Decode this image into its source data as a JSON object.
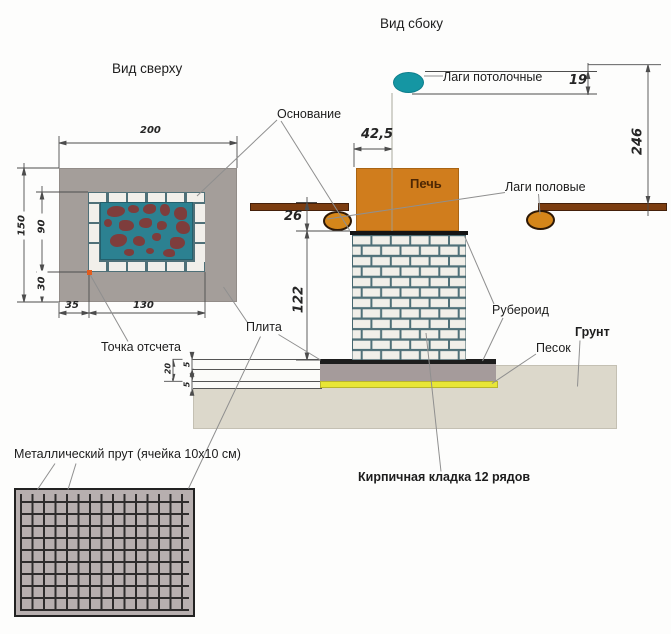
{
  "diagram": {
    "title_side_view": "Вид сбоку",
    "title_top_view": "Вид сверху",
    "labels": {
      "base": "Основание",
      "ceiling_joists": "Лаги потолочные",
      "furnace": "Печь",
      "floor_joists": "Лаги половые",
      "ruberoid": "Рубероид",
      "slab": "Плита",
      "reference_point": "Точка отсчета",
      "sand": "Песок",
      "ground": "Грунт",
      "metal_mesh": "Металлический прут (ячейка 10х10 см)",
      "brickwork": "Кирпичная кладка 12 рядов"
    },
    "dimensions": {
      "top_view_width": "200",
      "top_view_height": "150",
      "inner_height": "90",
      "bottom_margin": "30",
      "side_margin": "35",
      "inner_width": "130",
      "furnace_offset": "42,5",
      "joist_gap": "26",
      "column_height": "122",
      "ceiling_joist_diameter": "19",
      "ceiling_height": "246",
      "slab_thickness": "20",
      "layer_top": "5",
      "layer_bottom": "5"
    },
    "colors": {
      "furnace_orange": "#d07d1d",
      "wood_brown": "#7c3d10",
      "joist_orange": "#d5861a",
      "ceiling_joist_teal": "#1596a3",
      "brick_white": "#f1efea",
      "mortar_teal": "#4f7078",
      "stone_maroon": "#7e3d3c",
      "inner_teal": "#2c8191",
      "slab_gray": "#a59b9b",
      "sand_yellow": "#e8e636",
      "ground_beige": "#dcd8cb",
      "mesh_gray": "#b7afaf",
      "ruberoid_black": "#1d1d1d",
      "reference_point_orange": "#e35c1d"
    }
  }
}
